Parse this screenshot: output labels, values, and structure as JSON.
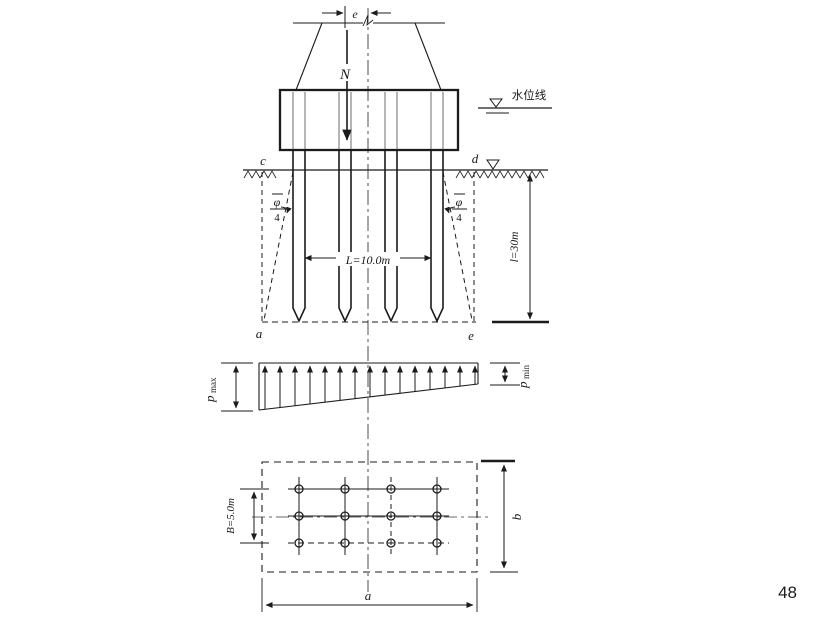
{
  "page_number": "48",
  "pier": {
    "eccentricity_label": "e",
    "load_label": "N"
  },
  "water": {
    "level_line_label": "水位线"
  },
  "ground": {
    "left_point_label": "c",
    "right_point_label": "d"
  },
  "pile_section": {
    "group_width_label": "L=10.0m",
    "depth_label": "l=30m",
    "spread_angle_numerator": "φ",
    "spread_angle_denominator": "4",
    "bottom_left_point_label": "a",
    "bottom_right_point_label": "e"
  },
  "pressure": {
    "p_symbol": "p",
    "max_subscript": "max",
    "min_subscript": "min"
  },
  "plan": {
    "row_width_label": "B=5.0m",
    "length_label": "a",
    "width_label": "b"
  }
}
